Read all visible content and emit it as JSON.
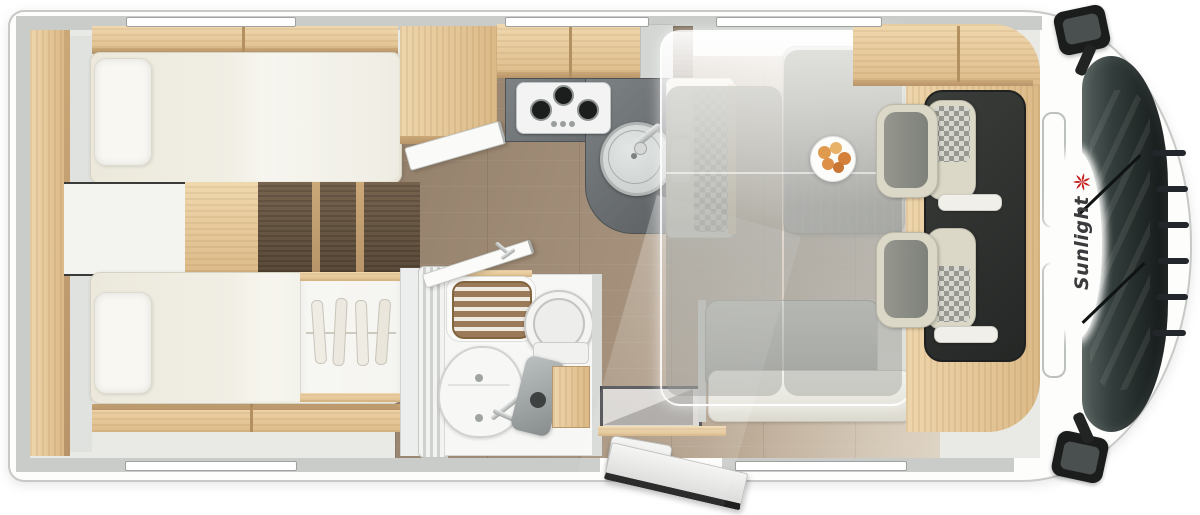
{
  "brand": {
    "label": "Sunlight",
    "icon": "sunburst-icon",
    "icon_color": "#c42020",
    "text_color": "#3b3b3d"
  },
  "palette": {
    "body_white": "#fdfdfc",
    "wall_grey": "#c9ccc9",
    "oak_light": "#e6c89c",
    "walnut_dark": "#6b5948",
    "floor_wood": "#a18c77",
    "counter_grey": "#5c6062",
    "mattress_cream": "#efede2",
    "cab_floor_dark": "#2f322f",
    "seat_grey": "#8f918b",
    "seat_cream": "#dbd8c7"
  },
  "features": {
    "icons": [
      "twin-bed-top",
      "twin-bed-bottom",
      "pillow",
      "bed-steps",
      "wardrobe-hangers-icon",
      "gas-hob-3-burner-icon",
      "kitchen-sink-icon",
      "faucet-icon",
      "shower-grate-icon",
      "toilet-icon",
      "washbasin-icon",
      "bathroom-door",
      "entry-door",
      "entry-step",
      "dinette-table",
      "fruit-plate-icon",
      "bench-seat",
      "drop-down-bed-overlay",
      "swivel-seat",
      "headrest-checker",
      "windshield",
      "side-mirror-icon",
      "sunburst-icon"
    ]
  }
}
